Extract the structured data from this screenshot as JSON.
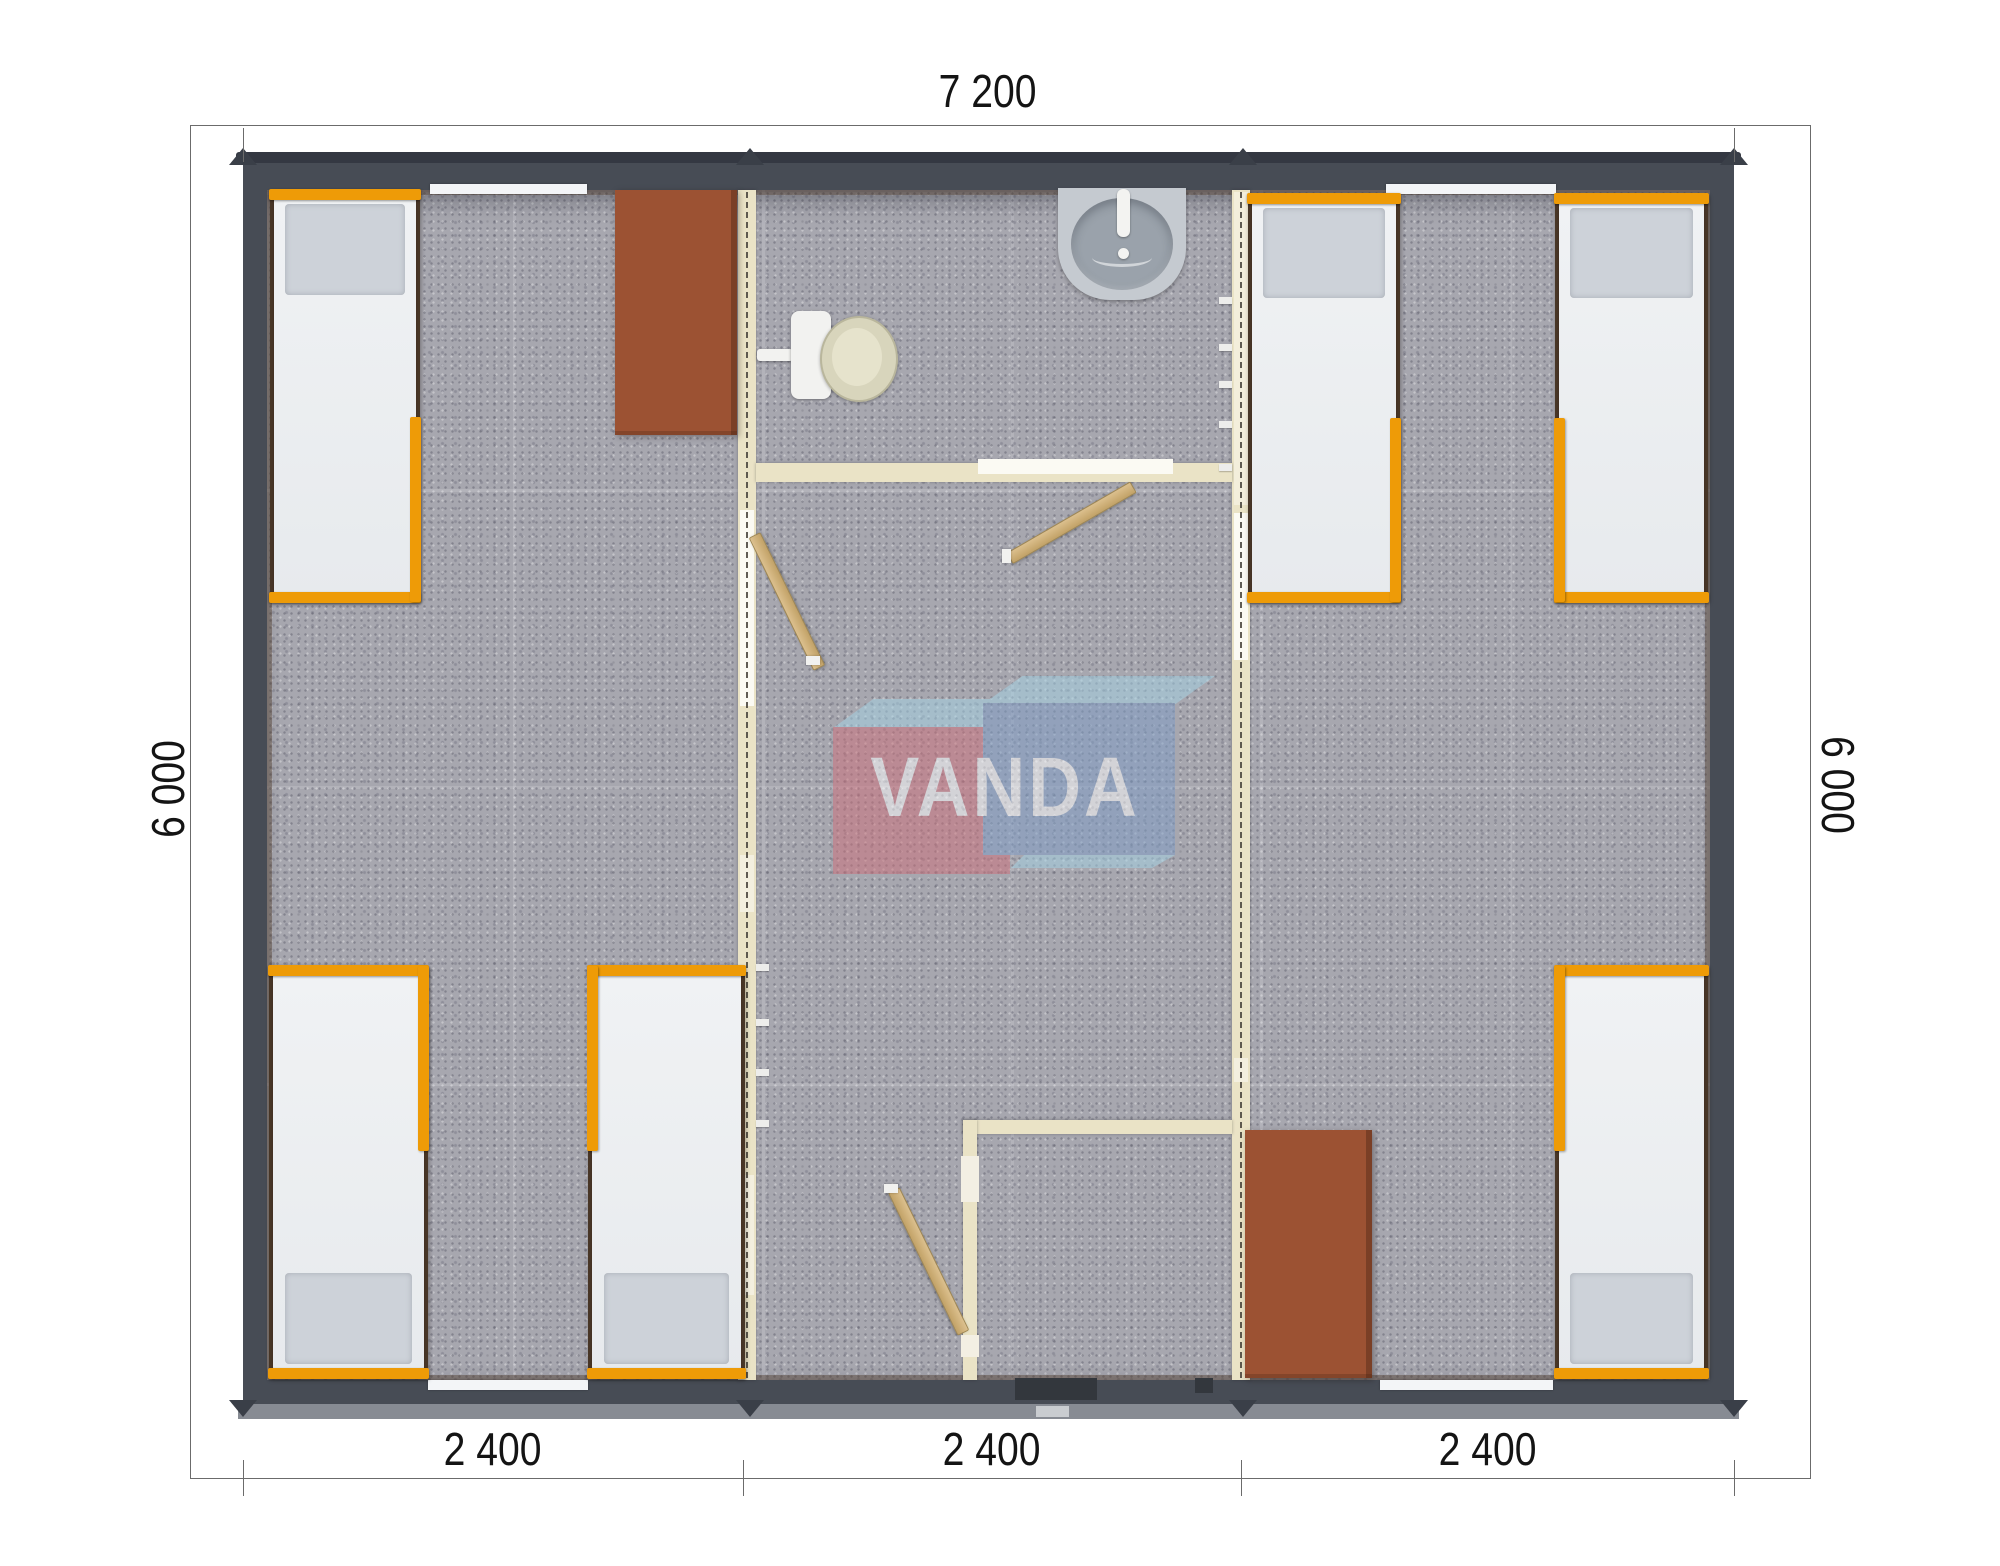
{
  "meta": {
    "width": 2000,
    "height": 1566,
    "background": "#ffffff",
    "view": "top-down modular cabin floor plan"
  },
  "watermark": {
    "text": "VANDA",
    "opacity": 0.5,
    "colors": {
      "red_box": "#cf6f7a",
      "blue_box": "#7e9dc7",
      "light_blue_top": "#a4d3e6",
      "text": "#ffffff"
    }
  },
  "dimensions": {
    "top": "7 200",
    "left": "6 000",
    "right": "6 000",
    "bottom": [
      "2 400",
      "2 400",
      "2 400"
    ]
  },
  "palette": {
    "exterior_wall": "#474c55",
    "roof_lip": "#343842",
    "base_strip": "#878b93",
    "floor": "#a7a7af",
    "partition_wall": "#eae3c6",
    "door_wood": "#c9ab72",
    "bed_frame_orange": "#ee9b07",
    "mattress": "#eef0f2",
    "pillow": "#cdd2d9",
    "table_brown": "#9c5233",
    "sanitary_gray": "#9aa2ab",
    "dimension_text": "#141414"
  },
  "plan": {
    "walls": [
      {
        "name": "partition-wall-left",
        "x": 738,
        "y": 190,
        "w": 18,
        "h": 1190
      },
      {
        "name": "partition-wall-right",
        "x": 1232,
        "y": 190,
        "w": 18,
        "h": 1190
      },
      {
        "name": "bathroom-wall",
        "x": 756,
        "y": 463,
        "w": 476,
        "h": 19
      },
      {
        "name": "vestibule-wall-top",
        "x": 963,
        "y": 1120,
        "w": 269,
        "h": 14
      },
      {
        "name": "vestibule-wall-side",
        "x": 963,
        "y": 1120,
        "w": 14,
        "h": 260
      }
    ],
    "overlays": [
      {
        "name": "door-opening",
        "x": 740,
        "y": 510,
        "w": 14,
        "h": 196,
        "c": "#fbfaf3"
      },
      {
        "name": "wall-panel",
        "x": 740,
        "y": 855,
        "w": 14,
        "h": 57,
        "c": "#f3efdf"
      },
      {
        "name": "wall-panel",
        "x": 740,
        "y": 1175,
        "w": 14,
        "h": 120,
        "c": "#f3efdf"
      },
      {
        "name": "wall-panel",
        "x": 1234,
        "y": 192,
        "w": 14,
        "h": 313,
        "c": "#f3eedb"
      },
      {
        "name": "door-opening",
        "x": 1234,
        "y": 513,
        "w": 14,
        "h": 147,
        "c": "#fbfaf3"
      },
      {
        "name": "wall-panel",
        "x": 1234,
        "y": 1058,
        "w": 14,
        "h": 24,
        "c": "#f3efdf"
      },
      {
        "name": "door-opening",
        "x": 978,
        "y": 459,
        "w": 195,
        "h": 15,
        "c": "#fbfaf3"
      },
      {
        "name": "door-jamb",
        "x": 961,
        "y": 1156,
        "w": 18,
        "h": 46,
        "c": "#f3efe3"
      },
      {
        "name": "door-jamb",
        "x": 961,
        "y": 1335,
        "w": 18,
        "h": 22,
        "c": "#f3efe3"
      }
    ],
    "dash_x": [
      746,
      1240
    ],
    "hooks": [
      {
        "x": 756,
        "y": 964
      },
      {
        "x": 756,
        "y": 1019
      },
      {
        "x": 756,
        "y": 1069
      },
      {
        "x": 756,
        "y": 1120
      },
      {
        "x": 1219,
        "y": 297
      },
      {
        "x": 1219,
        "y": 344
      },
      {
        "x": 1219,
        "y": 381
      },
      {
        "x": 1219,
        "y": 421
      },
      {
        "x": 1219,
        "y": 464
      }
    ],
    "windows": [
      {
        "x": 430,
        "y": 184,
        "w": 157,
        "h": 10
      },
      {
        "x": 1386,
        "y": 184,
        "w": 170,
        "h": 10
      },
      {
        "x": 428,
        "y": 1380,
        "w": 160,
        "h": 10
      },
      {
        "x": 1380,
        "y": 1380,
        "w": 173,
        "h": 10
      }
    ],
    "entrance": [
      {
        "name": "entrance-door",
        "x": 1015,
        "y": 1378,
        "w": 82,
        "h": 22,
        "c": "#33373d"
      },
      {
        "name": "entrance-vent",
        "x": 1195,
        "y": 1378,
        "w": 18,
        "h": 15,
        "c": "#33373d"
      },
      {
        "name": "entrance-step",
        "x": 1036,
        "y": 1406,
        "w": 33,
        "h": 11,
        "c": "#c9ccd0"
      }
    ],
    "roof_xs": [
      243,
      750,
      1243,
      1734
    ],
    "doors": [
      {
        "x": 748,
        "y": 535,
        "w": 11,
        "h": 146,
        "rot": -26
      },
      {
        "x": 1127,
        "y": 487,
        "w": 11,
        "h": 141,
        "rot": 60
      },
      {
        "x": 957,
        "y": 1333,
        "w": 11,
        "h": 157,
        "rot": 154
      }
    ],
    "door_caps": [
      {
        "x": 806,
        "y": 656,
        "w": 14,
        "h": 9
      },
      {
        "x": 1002,
        "y": 549,
        "w": 9,
        "h": 14
      },
      {
        "x": 884,
        "y": 1184,
        "w": 14,
        "h": 9
      }
    ],
    "beds": [
      {
        "x": 270,
        "y": 190,
        "w": 150,
        "h": 412,
        "pillow": "top",
        "rail": "right"
      },
      {
        "x": 269,
        "y": 966,
        "w": 159,
        "h": 412,
        "pillow": "bottom",
        "rail": "right"
      },
      {
        "x": 588,
        "y": 966,
        "w": 157,
        "h": 412,
        "pillow": "bottom",
        "rail": "left"
      },
      {
        "x": 1248,
        "y": 194,
        "w": 152,
        "h": 408,
        "pillow": "top",
        "rail": "right"
      },
      {
        "x": 1555,
        "y": 194,
        "w": 153,
        "h": 408,
        "pillow": "top",
        "rail": "left"
      },
      {
        "x": 1555,
        "y": 966,
        "w": 153,
        "h": 412,
        "pillow": "bottom",
        "rail": "left"
      }
    ],
    "tables": [
      {
        "x": 615,
        "y": 190,
        "w": 122,
        "h": 245
      },
      {
        "x": 1245,
        "y": 1130,
        "w": 127,
        "h": 248
      }
    ],
    "toilet": {
      "pipe": {
        "x": 757,
        "y": 349,
        "w": 36,
        "h": 12
      },
      "tank": {
        "x": 791,
        "y": 311,
        "w": 40,
        "h": 88
      },
      "bowl": {
        "x": 820,
        "y": 316,
        "w": 74,
        "h": 82
      },
      "seat": {
        "x": 832,
        "y": 328,
        "w": 50,
        "h": 58
      }
    },
    "sink": {
      "base": {
        "x": 1058,
        "y": 188,
        "w": 128,
        "h": 112
      },
      "basin": {
        "x": 1071,
        "y": 198,
        "w": 102,
        "h": 92
      },
      "faucet": {
        "x": 1117,
        "y": 189,
        "w": 13,
        "h": 48
      },
      "knob": {
        "x": 1118,
        "y": 248,
        "w": 11,
        "h": 11
      },
      "drain": {
        "x": 1092,
        "y": 248,
        "w": 60,
        "h": 16
      }
    }
  }
}
